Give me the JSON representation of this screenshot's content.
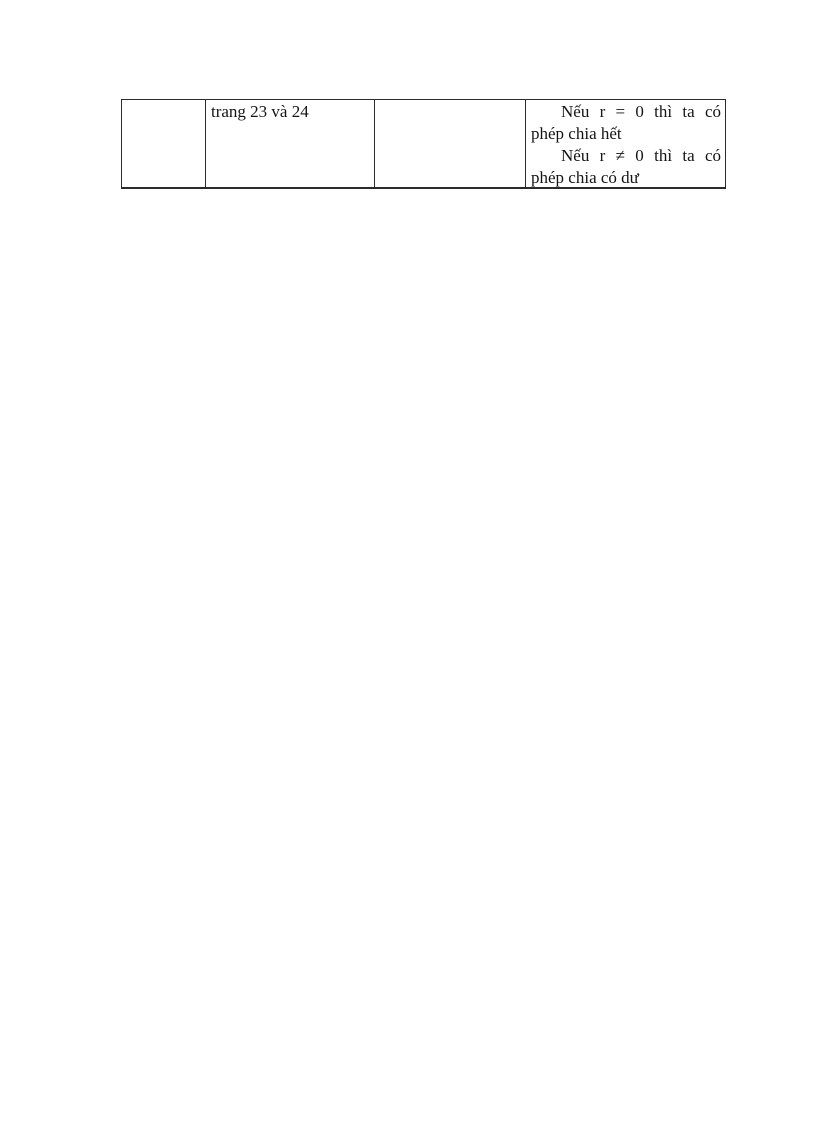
{
  "theme": {
    "page_background": "#ffffff",
    "table_border": "#2b2b2b",
    "text_color": "#141414"
  },
  "table": {
    "row": {
      "cell1": {
        "text": ""
      },
      "cell2": {
        "text": "trang 23 và 24"
      },
      "cell3": {
        "text": ""
      },
      "cell4": {
        "paragraphs": [
          "Nếu r = 0 thì ta có phép chia hết",
          "Nếu r ≠ 0 thì ta có phép chia có dư"
        ]
      }
    }
  }
}
